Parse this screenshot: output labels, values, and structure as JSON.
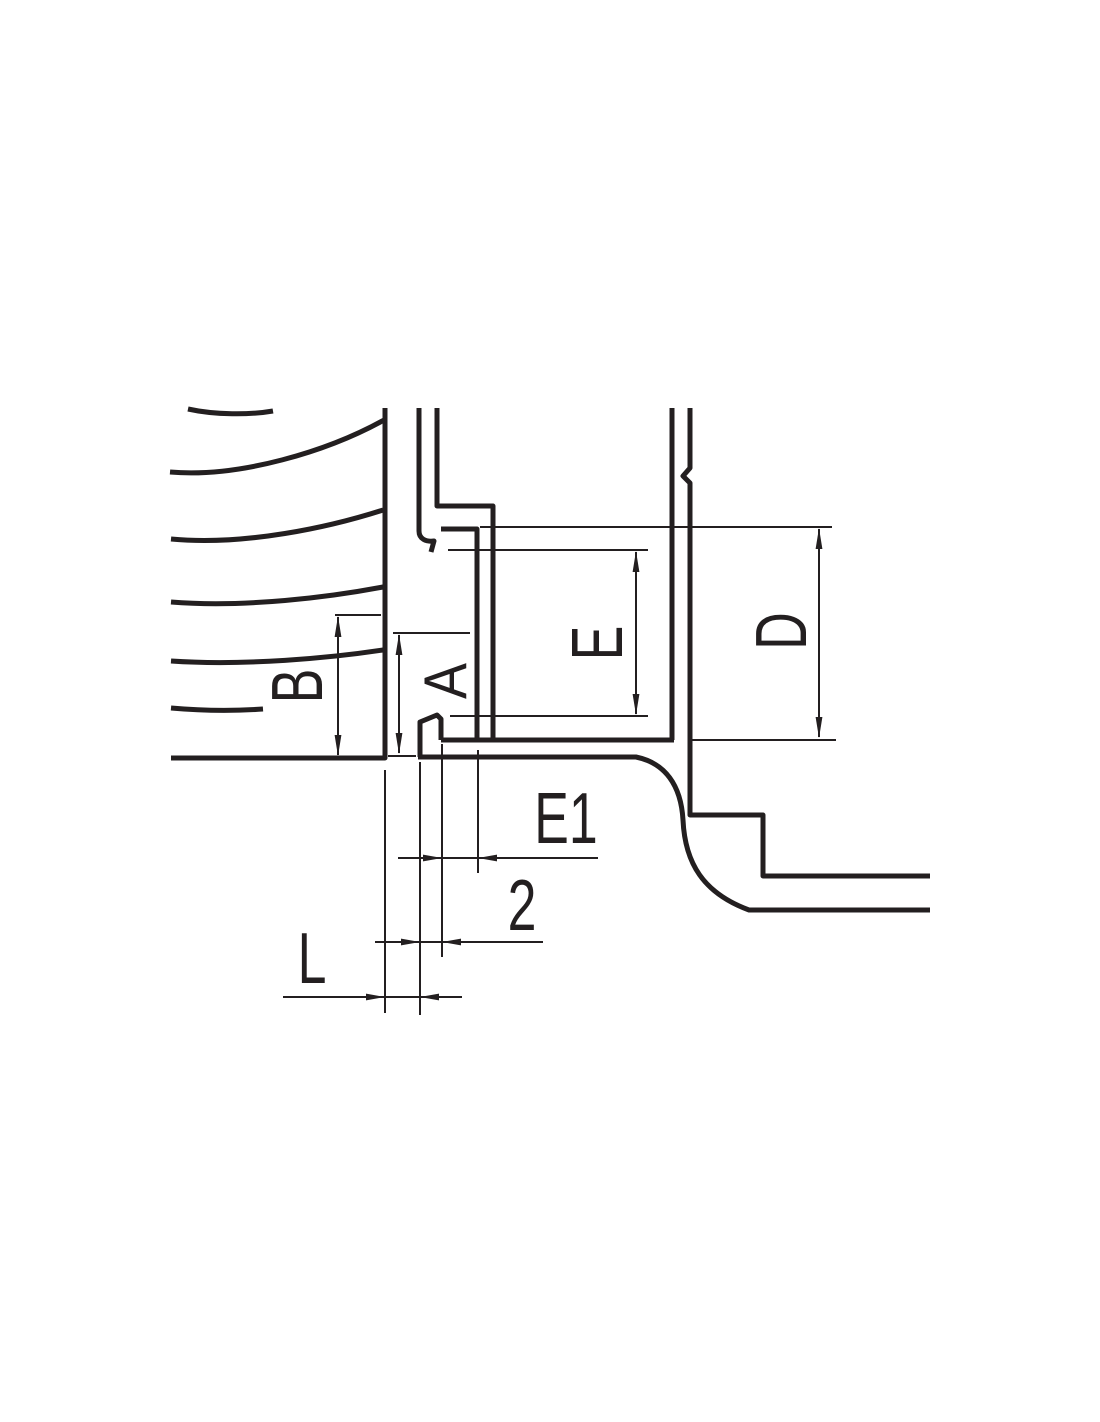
{
  "drawing": {
    "kind": "technical cross-section with dimensioning",
    "colors": {
      "ink": "#231f20",
      "background": "#ffffff"
    },
    "dimension_labels": {
      "b": {
        "label": "B",
        "orientation": "rotated-90ccw"
      },
      "a": {
        "label": "A",
        "orientation": "rotated-90ccw"
      },
      "e": {
        "label": "E",
        "orientation": "rotated-90ccw"
      },
      "d": {
        "label": "D",
        "orientation": "rotated-90ccw"
      },
      "e1": {
        "label": "E1",
        "orientation": "horizontal"
      },
      "gap": {
        "label": "2",
        "orientation": "horizontal"
      },
      "l": {
        "label": "L",
        "orientation": "horizontal"
      }
    }
  }
}
